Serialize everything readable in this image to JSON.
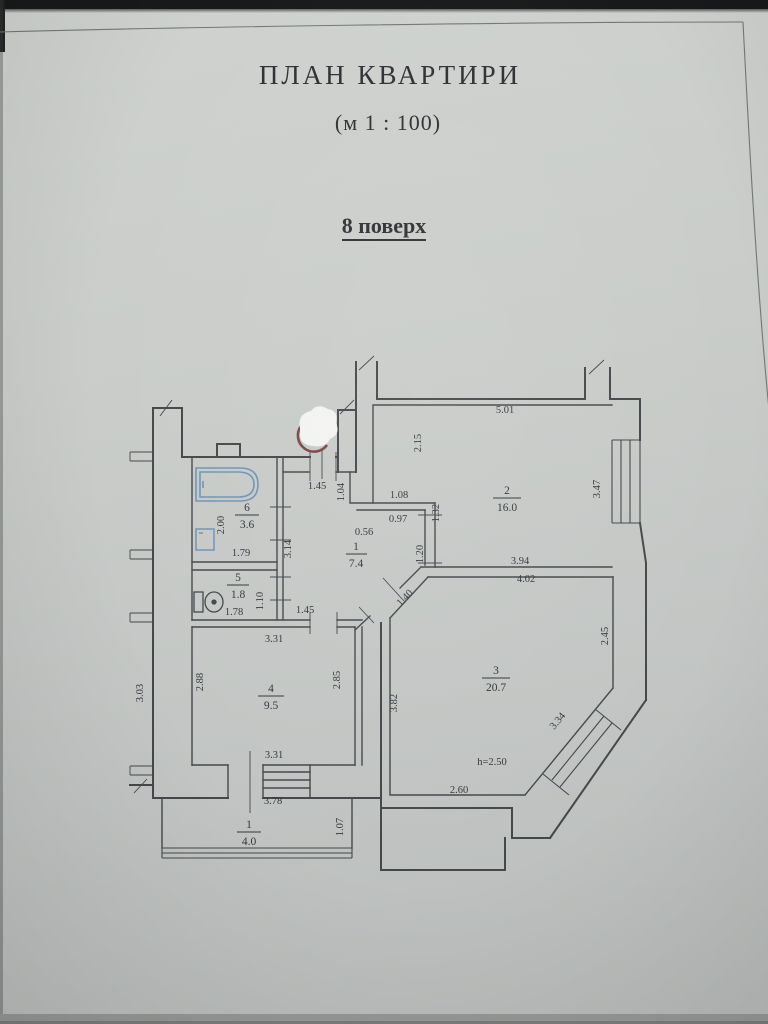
{
  "document": {
    "title": "ПЛАН КВАРТИРИ",
    "scale": "(м 1 : 100)",
    "floor_label": "8 поверх"
  },
  "plan": {
    "rooms": [
      {
        "id": "hallway",
        "number": "1",
        "area": "7.4"
      },
      {
        "id": "room-2",
        "number": "2",
        "area": "16.0"
      },
      {
        "id": "room-3",
        "number": "3",
        "area": "20.7"
      },
      {
        "id": "room-4",
        "number": "4",
        "area": "9.5"
      },
      {
        "id": "wc",
        "number": "5",
        "area": "1.8"
      },
      {
        "id": "bathroom",
        "number": "6",
        "area": "3.6"
      },
      {
        "id": "balcony",
        "number": "1",
        "area": "4.0"
      }
    ],
    "dims": {
      "entry_width": "1.45",
      "room2_top": "5.01",
      "room2_left": "2.15",
      "room2_right": "3.47",
      "room2_bottom_inner": "3.94",
      "room2_bottom_outer": "4.02",
      "hall_right_upper": "1.04",
      "hall_step_top": "1.08",
      "hall_step_bottom": "0.97",
      "hall_nook": "0.56",
      "hall_wall_right": "1.32",
      "hall_door_room2": "1.20",
      "hall_left": "3.14",
      "hall_door_room4": "1.45",
      "hall_door_room3": "1.40",
      "bath_depth": "2.00",
      "bath_width": "1.79",
      "wc_width": "1.78",
      "wc_depth": "1.10",
      "room4_top": "3.31",
      "room4_left": "2.88",
      "room4_right": "2.85",
      "room4_bottom": "3.31",
      "room3_left": "3.82",
      "room3_right": "2.45",
      "room3_window": "3.34",
      "room3_bottom": "2.60",
      "ceiling_height": "h=2.50",
      "outer_left": "3.03",
      "balcony_top": "3.78",
      "balcony_right": "1.07"
    },
    "colors": {
      "ink": "#45484b",
      "blue_ink": "#3d5a8f",
      "fixture_blue": "#6f94b8",
      "paper": "#c6c9c6"
    }
  }
}
